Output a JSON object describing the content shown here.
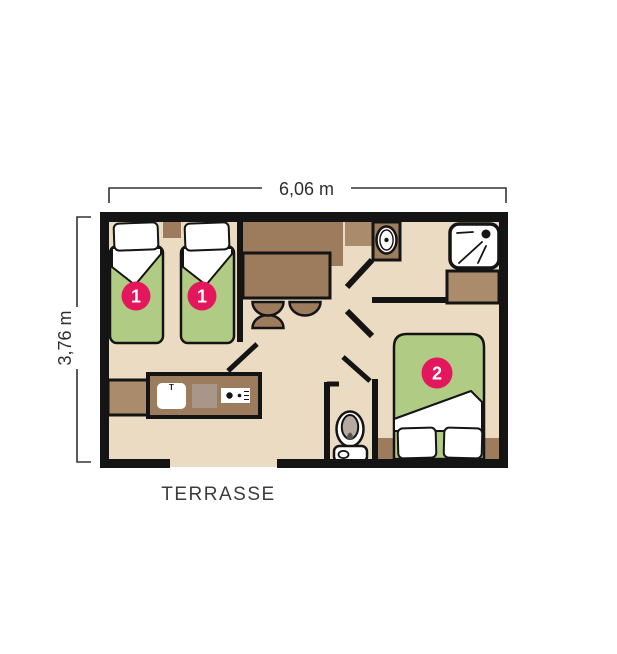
{
  "plan": {
    "width_label": "6,06 m",
    "height_label": "3,76 m",
    "terrace_label": "TERRASSE",
    "badges": {
      "bedroom1_bed_a": "1",
      "bedroom1_bed_b": "1",
      "bedroom2_bed": "2"
    },
    "kitchen": {
      "faucet_mark": "T"
    }
  },
  "colors": {
    "background": "#ffffff",
    "floor": "#eadbc2",
    "wall": "#141414",
    "wood_dark": "#9c7c5c",
    "wood_light": "#aa8c6c",
    "mattress_green": "#b0cc84",
    "badge_pink": "#e4175c",
    "fixture_white": "#ffffff",
    "counter_gray": "#a79689",
    "toilet_gray": "#b5a9a0",
    "seat_dark": "#5a524b",
    "text": "#3c3c3c"
  }
}
